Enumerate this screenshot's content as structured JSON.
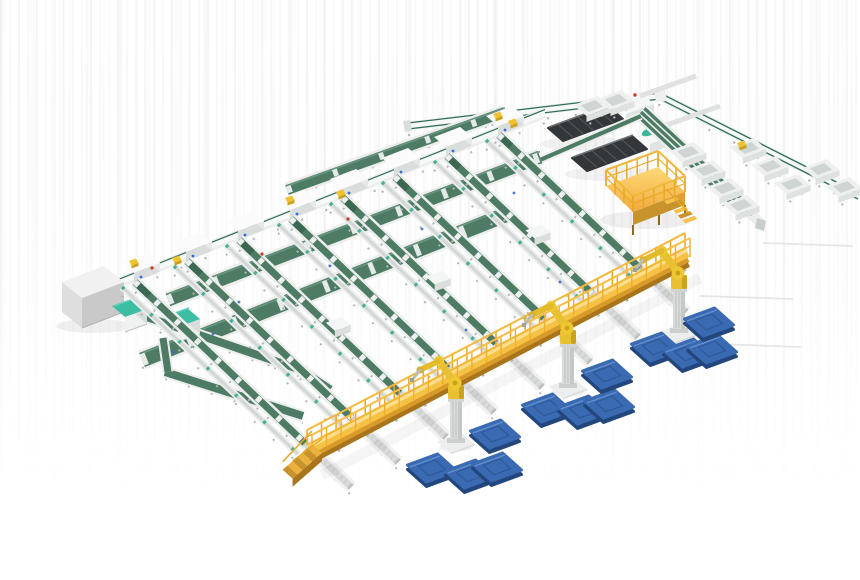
{
  "meta": {
    "title": "Automated sorting facility - isometric 3D render",
    "scene_type": "industrial-3d-render",
    "canvas": {
      "width": 860,
      "height": 580
    }
  },
  "palette": {
    "beltGreen": "#4d7b63",
    "beltGreenDark": "#3b6852",
    "beltEdge": "#2f6e55",
    "beltLight": "#6b9680",
    "frameWhite": "#eceeed",
    "bedWhite": "#f7f8f8",
    "bedGray": "#d3d7d5",
    "legGray": "#b3b7b5",
    "machineDark": "#33373a",
    "machineRib": "#565b5f",
    "machineTopEdge": "#6d7478",
    "headWhite": "#f5f7f7",
    "headSide": "#dfe3e3",
    "teal": "#3bb598",
    "tealTop": "#3dbda1",
    "tealSheen": "#5ccfb6",
    "cabinetTop": "#f1f1f1",
    "cabinetLeft": "#dedede",
    "cabinetFront": "#c9c9c9",
    "deckYellow": "#f6c246",
    "deckLight": "#ffdf8e",
    "deckSide": "#d89a28",
    "deckDark": "#a8741c",
    "rail": "#e9a825",
    "stepAlt": "#c8922c",
    "platTop1": "#ffd978",
    "platTop2": "#f0ab3e",
    "robotYellow": "#e8c133",
    "robotLight": "#eec832",
    "robotShade": "#caa21e",
    "pedestal": "#d9dcdb",
    "pedestalShade": "#c4c8c6",
    "basePlate": "#cbcfcd",
    "palletTop": "#3a6ab2",
    "palletSide": "#23477d",
    "palletHi": "#6b97d1",
    "palletLine": "#2d5694",
    "binRim": "#eef0ef",
    "binCavity": "#ced5d3",
    "binFront": "#dde1e0",
    "red": "#cc3b2a",
    "blue": "#3a6cd0",
    "packageYellow": "#f0c22f",
    "packageSide": "#caa21e",
    "floorLine": "#e2e2e2",
    "shadow": "#000000"
  },
  "scene": {
    "floor_lines": [
      {
        "x1": 763,
        "y1": 243,
        "x2": 853,
        "y2": 246
      },
      {
        "x1": 700,
        "y1": 296,
        "x2": 793,
        "y2": 299
      },
      {
        "x1": 718,
        "y1": 344,
        "x2": 801,
        "y2": 347
      }
    ],
    "cabinet": {
      "origin": [
        62,
        282
      ],
      "u": [
        42,
        -16
      ],
      "v": [
        20,
        16
      ],
      "height": 30
    },
    "infeed": {
      "from": [
        108,
        287
      ],
      "to": [
        545,
        113
      ]
    },
    "top_l_conveyor": {
      "points": [
        [
          408,
          126
        ],
        [
          660,
          96
        ],
        [
          858,
          196
        ]
      ]
    },
    "right_sorter": {
      "from": [
        641,
        112
      ],
      "to": [
        748,
        212
      ],
      "tail": [
        762,
        224
      ]
    },
    "grid_connector": {
      "from": [
        540,
        160
      ],
      "to": [
        641,
        116
      ]
    },
    "cross_belts": [
      {
        "from": [
          287,
          190
        ],
        "to": [
          505,
          112
        ],
        "w": 10
      },
      {
        "from": [
          168,
          300
        ],
        "to": [
          540,
          157
        ],
        "w": 13
      },
      {
        "from": [
          142,
          360
        ],
        "to": [
          505,
          215
        ],
        "w": 15
      }
    ],
    "loop": {
      "bands": [
        {
          "from": [
            138,
            314
          ],
          "to": [
            307,
            372
          ],
          "w": 8
        },
        {
          "from": [
            165,
            372
          ],
          "to": [
            303,
            416
          ],
          "w": 8
        },
        {
          "from": [
            163,
            338
          ],
          "to": [
            168,
            372
          ],
          "w": 7
        },
        {
          "from": [
            303,
            372
          ],
          "to": [
            330,
            390
          ],
          "w": 9
        }
      ],
      "machines": [
        [
          112,
          306
        ],
        [
          165,
          316
        ]
      ]
    },
    "dark_machines": [
      {
        "anchor": [
          548,
          128
        ]
      },
      {
        "anchor": [
          572,
          158
        ]
      }
    ],
    "stations": [
      {
        "pos": [
          125,
          272
        ],
        "accent": "yellow"
      },
      {
        "pos": [
          177,
          251
        ],
        "accent": "none"
      },
      {
        "pos": [
          229,
          230
        ],
        "accent": "none"
      },
      {
        "pos": [
          281,
          209
        ],
        "accent": "yellow"
      },
      {
        "pos": [
          333,
          188
        ],
        "accent": "none"
      },
      {
        "pos": [
          385,
          167
        ],
        "accent": "none"
      },
      {
        "pos": [
          437,
          146
        ],
        "accent": "none"
      },
      {
        "pos": [
          489,
          125
        ],
        "accent": "yellow"
      }
    ],
    "lanes": [
      {
        "head": [
          135,
          282
        ],
        "foot": [
          311,
          449
        ]
      },
      {
        "head": [
          187,
          261
        ],
        "foot": [
          358,
          424
        ]
      },
      {
        "head": [
          239,
          240
        ],
        "foot": [
          406,
          399
        ]
      },
      {
        "head": [
          291,
          219
        ],
        "foot": [
          454,
          374
        ]
      },
      {
        "head": [
          343,
          198
        ],
        "foot": [
          502,
          349
        ]
      },
      {
        "head": [
          395,
          177
        ],
        "foot": [
          550,
          324
        ]
      },
      {
        "head": [
          447,
          156
        ],
        "foot": [
          598,
          299
        ]
      },
      {
        "head": [
          499,
          135
        ],
        "foot": [
          646,
          274
        ]
      }
    ],
    "spur_extension": [
      40,
      38
    ],
    "chute_bins": [
      [
        592,
        106
      ],
      [
        616,
        100
      ],
      [
        688,
        152
      ],
      [
        707,
        170
      ],
      [
        725,
        188
      ],
      [
        741,
        205
      ],
      [
        748,
        148
      ],
      [
        770,
        166
      ],
      [
        792,
        184
      ],
      [
        821,
        169
      ],
      [
        844,
        187
      ]
    ],
    "platform": {
      "corners": [
        [
          606,
          186
        ],
        [
          658,
          167
        ],
        [
          685,
          192
        ],
        [
          633,
          212
        ]
      ],
      "height": 13
    },
    "catwalk": {
      "from": [
        309,
        449
      ],
      "to": [
        687,
        252
      ]
    },
    "robots": [
      [
        456,
        443
      ],
      [
        568,
        388
      ],
      [
        679,
        333
      ]
    ],
    "pallets": [
      [
        432,
        468
      ],
      [
        470,
        474
      ],
      [
        497,
        467
      ],
      [
        495,
        434
      ],
      [
        547,
        408
      ],
      [
        583,
        410
      ],
      [
        609,
        404
      ],
      [
        607,
        374
      ],
      [
        656,
        347
      ],
      [
        688,
        353
      ],
      [
        712,
        349
      ],
      [
        709,
        322
      ]
    ],
    "accents": {
      "red_dots": [
        [
          152,
          268
        ],
        [
          262,
          254
        ],
        [
          348,
          219
        ]
      ],
      "blue_dots": [
        [
          173,
          352
        ],
        [
          213,
          334
        ],
        [
          239,
          302
        ],
        [
          330,
          266
        ],
        [
          422,
          229
        ],
        [
          514,
          193
        ],
        [
          466,
          330
        ],
        [
          560,
          282
        ]
      ],
      "yellow_packages": [
        [
          172,
          258
        ],
        [
          336,
          192
        ],
        [
          508,
          121
        ],
        [
          737,
          143
        ]
      ]
    }
  }
}
